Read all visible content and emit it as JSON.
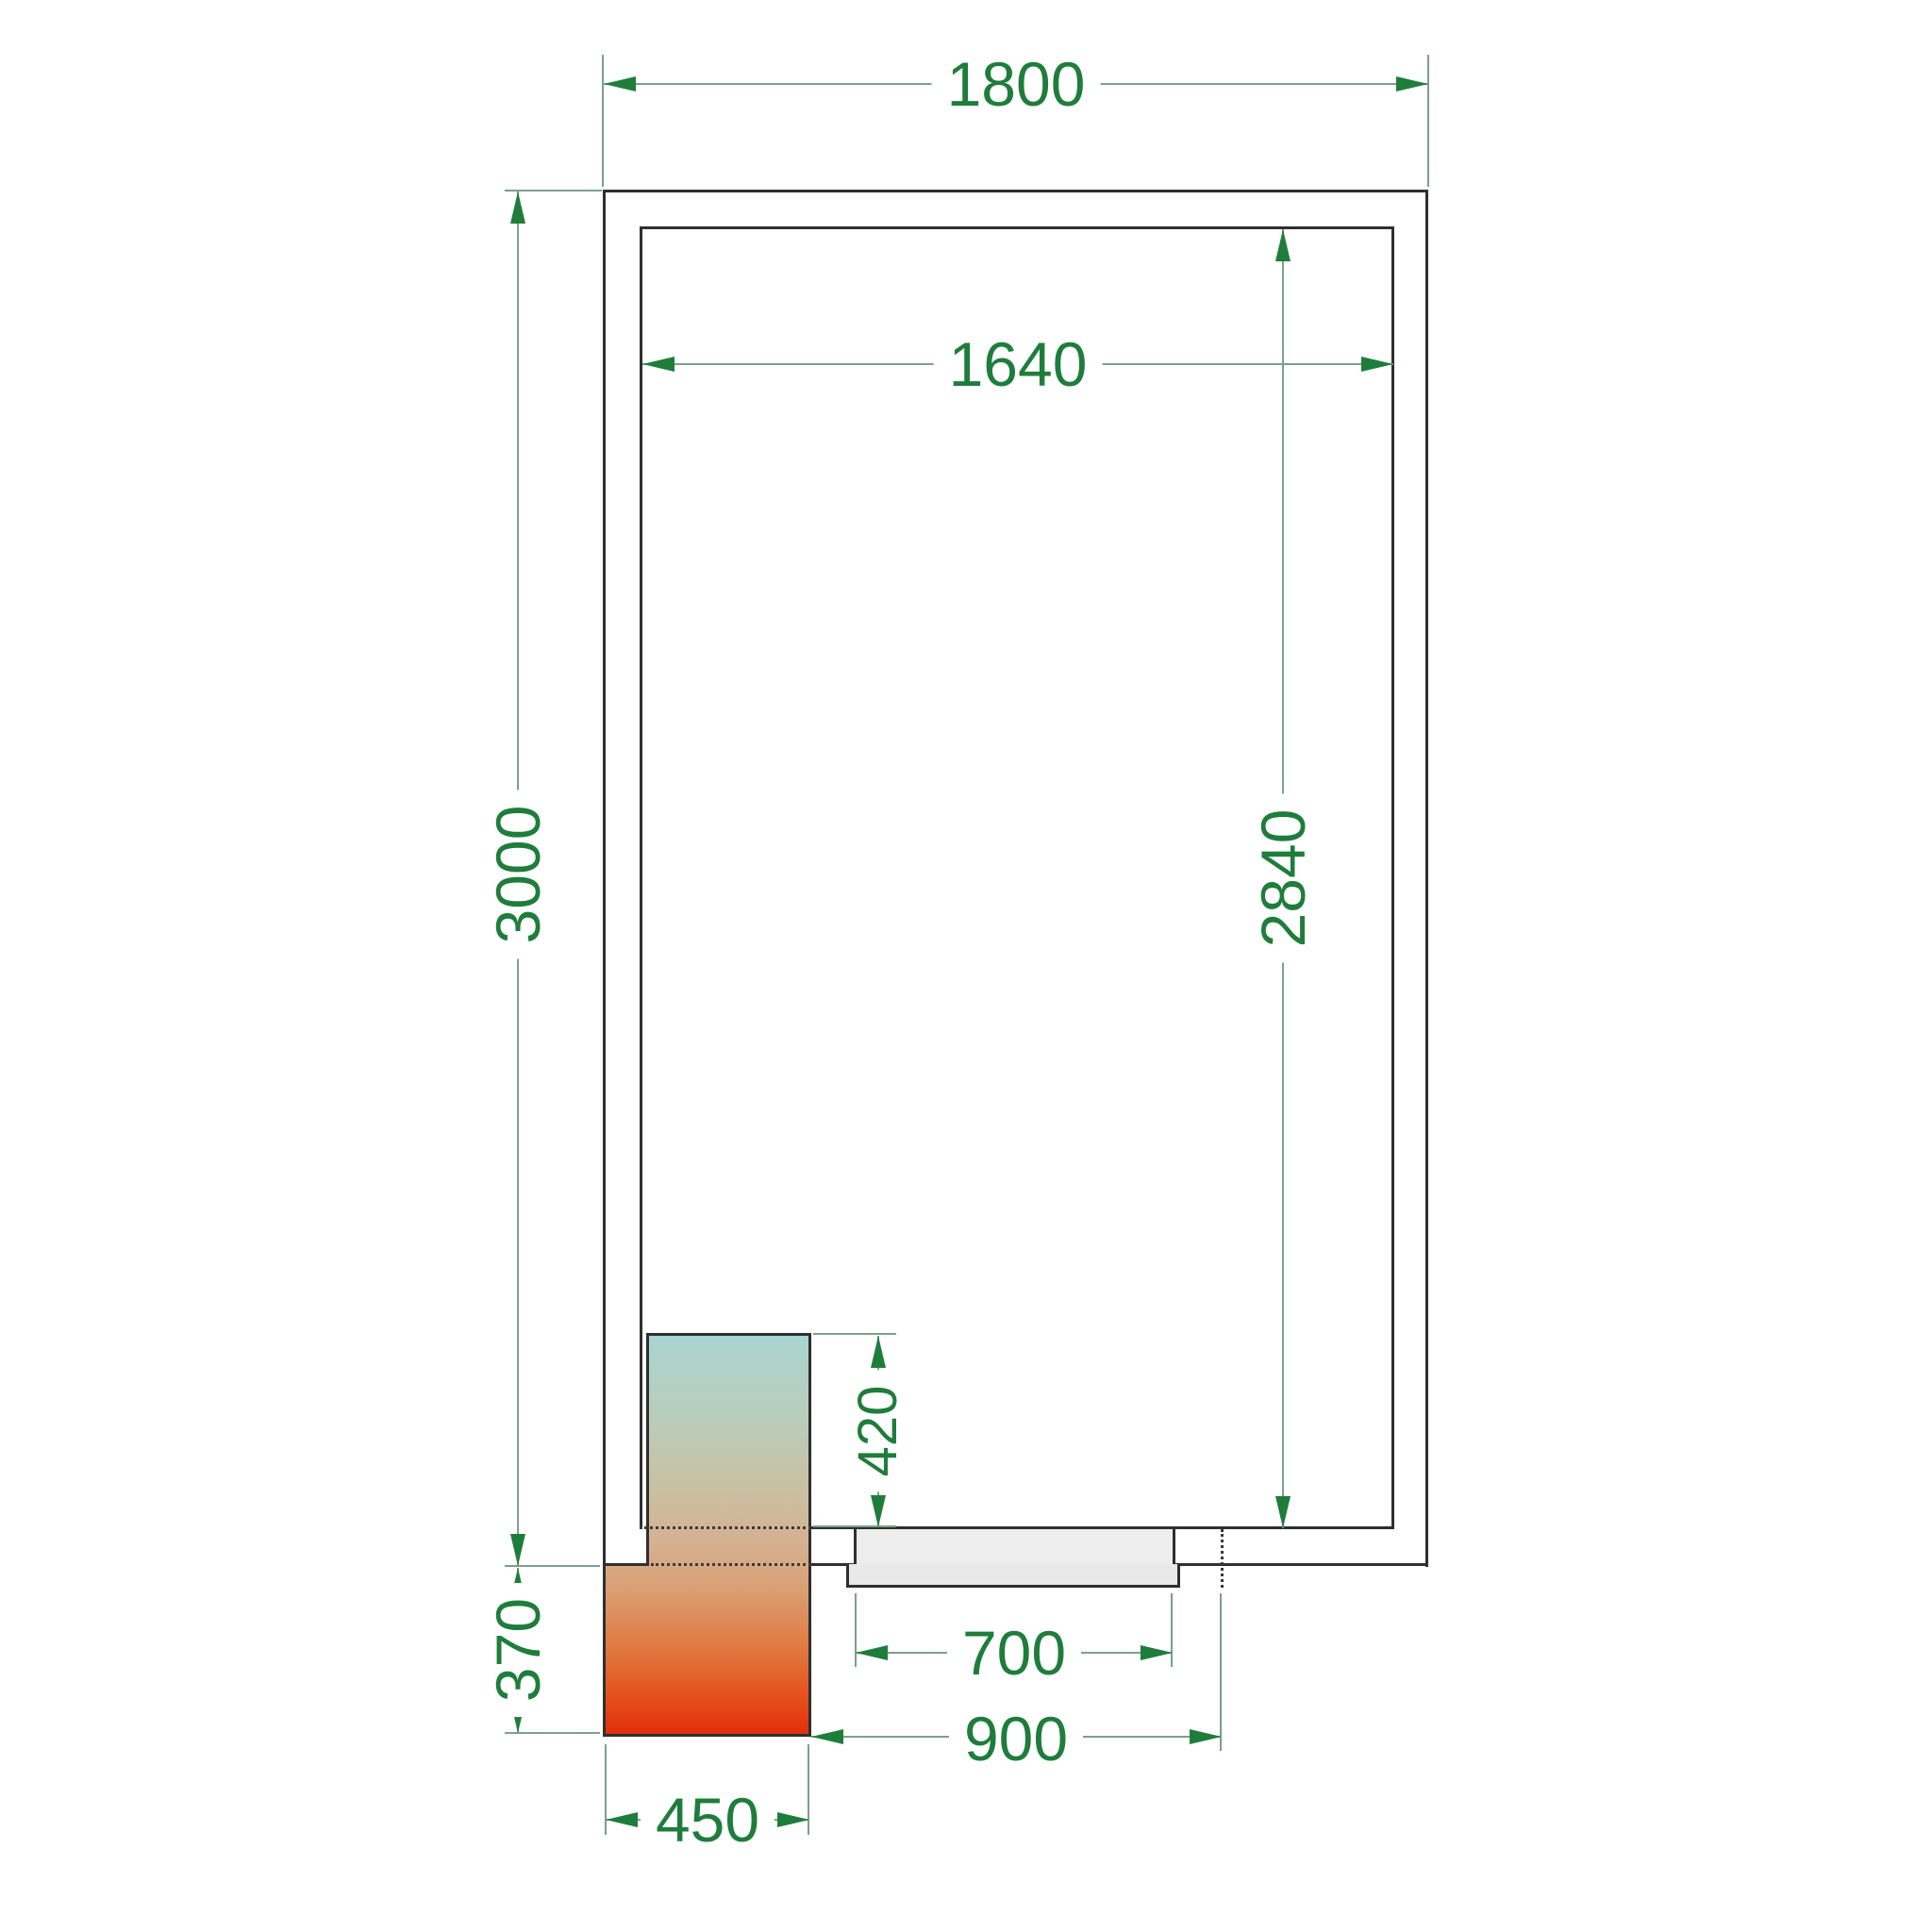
{
  "drawing": {
    "title": "cold-room-floor-plan-top-view",
    "dims": {
      "outer_width": "1800",
      "inner_width": "1640",
      "outer_depth": "3000",
      "inner_depth": "2840",
      "unit_inset": "420",
      "unit_protrusion": "370",
      "unit_width": "450",
      "door_opening": "700",
      "door_span": "900"
    },
    "colors": {
      "dimension_text": "#1f7d3b",
      "dimension_line": "#7aa08e",
      "wall_line": "#2f2f2f",
      "door_fill": "#e9e9e9",
      "unit_gradient_stops": [
        "#a9d4d2",
        "#b9cdbb",
        "#cbbfa0",
        "#d4b191",
        "#daa076",
        "#e07c44",
        "#e4511c",
        "#e22c0a"
      ]
    }
  }
}
